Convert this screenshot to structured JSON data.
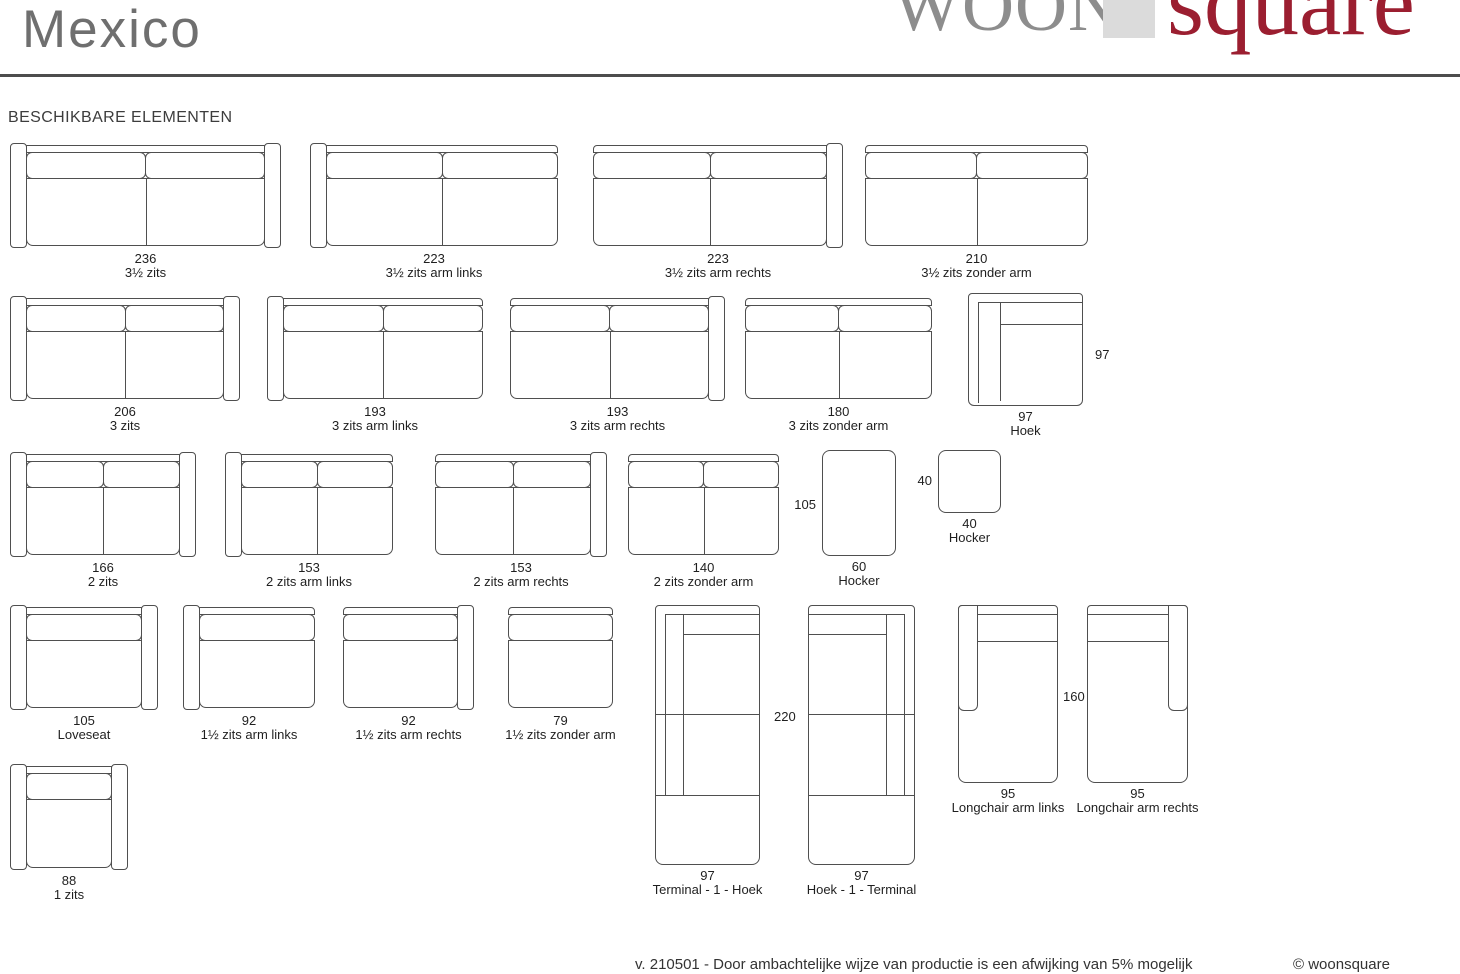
{
  "page": {
    "width": 1460,
    "height": 974,
    "line_color": "#4f4f4f"
  },
  "header": {
    "title": "Mexico",
    "rule_color": "#4d4d4d",
    "logo": {
      "woon": "WOON",
      "square_word": "square",
      "woon_color": "#8d8d8d",
      "square_color": "#9b1e30",
      "block_color": "#dbdbdb"
    }
  },
  "section": {
    "heading": "BESCHIKBARE ELEMENTEN"
  },
  "elements": [
    {
      "id": "3half-zits",
      "dim": "236",
      "label": "3½ zits",
      "type": "sofa",
      "arms": "both",
      "seats": 2,
      "x": 10,
      "y": 143,
      "w": 271,
      "h": 105
    },
    {
      "id": "3half-zits-arm-links",
      "dim": "223",
      "label": "3½ zits arm links",
      "type": "sofa",
      "arms": "left",
      "seats": 2,
      "x": 310,
      "y": 143,
      "w": 248,
      "h": 105
    },
    {
      "id": "3half-zits-arm-rechts",
      "dim": "223",
      "label": "3½ zits arm rechts",
      "type": "sofa",
      "arms": "right",
      "seats": 2,
      "x": 593,
      "y": 143,
      "w": 250,
      "h": 105
    },
    {
      "id": "3half-zits-zonder-arm",
      "dim": "210",
      "label": "3½ zits zonder arm",
      "type": "sofa",
      "arms": "none",
      "seats": 2,
      "x": 865,
      "y": 143,
      "w": 223,
      "h": 105
    },
    {
      "id": "3-zits",
      "dim": "206",
      "label": "3 zits",
      "type": "sofa",
      "arms": "both",
      "seats": 2,
      "x": 10,
      "y": 296,
      "w": 230,
      "h": 105
    },
    {
      "id": "3-zits-arm-links",
      "dim": "193",
      "label": "3 zits arm links",
      "type": "sofa",
      "arms": "left",
      "seats": 2,
      "x": 267,
      "y": 296,
      "w": 216,
      "h": 105
    },
    {
      "id": "3-zits-arm-rechts",
      "dim": "193",
      "label": "3 zits arm rechts",
      "type": "sofa",
      "arms": "right",
      "seats": 2,
      "x": 510,
      "y": 296,
      "w": 215,
      "h": 105
    },
    {
      "id": "3-zits-zonder-arm",
      "dim": "180",
      "label": "3 zits zonder arm",
      "type": "sofa",
      "arms": "none",
      "seats": 2,
      "x": 745,
      "y": 296,
      "w": 187,
      "h": 105
    },
    {
      "id": "hoek",
      "dim": "97",
      "label": "Hoek",
      "type": "hoek",
      "x": 968,
      "y": 293,
      "w": 115,
      "h": 113,
      "side": {
        "text": "97",
        "pos": "right",
        "dx": 12,
        "dy": 55
      }
    },
    {
      "id": "2-zits",
      "dim": "166",
      "label": "2 zits",
      "type": "sofa",
      "arms": "both",
      "seats": 2,
      "x": 10,
      "y": 452,
      "w": 186,
      "h": 105
    },
    {
      "id": "2-zits-arm-links",
      "dim": "153",
      "label": "2 zits arm links",
      "type": "sofa",
      "arms": "left",
      "seats": 2,
      "x": 225,
      "y": 452,
      "w": 168,
      "h": 105
    },
    {
      "id": "2-zits-arm-rechts",
      "dim": "153",
      "label": "2 zits arm rechts",
      "type": "sofa",
      "arms": "right",
      "seats": 2,
      "x": 435,
      "y": 452,
      "w": 172,
      "h": 105
    },
    {
      "id": "2-zits-zonder-arm",
      "dim": "140",
      "label": "2 zits zonder arm",
      "type": "sofa",
      "arms": "none",
      "seats": 2,
      "x": 628,
      "y": 452,
      "w": 151,
      "h": 105
    },
    {
      "id": "hocker-60",
      "dim": "60",
      "label": "Hocker",
      "type": "hocker",
      "x": 822,
      "y": 450,
      "w": 74,
      "h": 106,
      "side": {
        "text": "105",
        "pos": "left",
        "dy": 48
      }
    },
    {
      "id": "hocker-40",
      "dim": "40",
      "label": "Hocker",
      "type": "hocker",
      "x": 938,
      "y": 450,
      "w": 63,
      "h": 63,
      "side": {
        "text": "40",
        "pos": "left",
        "dy": 24
      }
    },
    {
      "id": "loveseat",
      "dim": "105",
      "label": "Loveseat",
      "type": "sofa",
      "arms": "both",
      "seats": 1,
      "x": 10,
      "y": 605,
      "w": 148,
      "h": 105
    },
    {
      "id": "1half-zits-arm-links",
      "dim": "92",
      "label": "1½ zits arm links",
      "type": "sofa",
      "arms": "left",
      "seats": 1,
      "x": 183,
      "y": 605,
      "w": 132,
      "h": 105
    },
    {
      "id": "1half-zits-arm-rechts",
      "dim": "92",
      "label": "1½ zits arm rechts",
      "type": "sofa",
      "arms": "right",
      "seats": 1,
      "x": 343,
      "y": 605,
      "w": 131,
      "h": 105
    },
    {
      "id": "1half-zits-zonder-arm",
      "dim": "79",
      "label": "1½ zits zonder arm",
      "type": "sofa",
      "arms": "none",
      "seats": 1,
      "x": 508,
      "y": 605,
      "w": 105,
      "h": 105
    },
    {
      "id": "terminal-1-hoek",
      "dim": "97",
      "label": "Terminal - 1 - Hoek",
      "type": "tall-corner",
      "backSide": "left",
      "x": 655,
      "y": 605,
      "w": 105,
      "h": 260,
      "side": {
        "text": "220",
        "pos": "right",
        "dx": 14,
        "dy": 105
      }
    },
    {
      "id": "hoek-1-terminal",
      "dim": "97",
      "label": "Hoek - 1 - Terminal",
      "type": "tall-corner",
      "backSide": "right",
      "x": 808,
      "y": 605,
      "w": 107,
      "h": 260
    },
    {
      "id": "longchair-arm-links",
      "dim": "95",
      "label": "Longchair arm links",
      "type": "longchair",
      "armSide": "left",
      "x": 958,
      "y": 605,
      "w": 100,
      "h": 178,
      "side": {
        "text": "160",
        "pos": "right",
        "dx": 5,
        "dy": 85
      }
    },
    {
      "id": "longchair-arm-rechts",
      "dim": "95",
      "label": "Longchair arm rechts",
      "type": "longchair",
      "armSide": "right",
      "x": 1087,
      "y": 605,
      "w": 101,
      "h": 178
    },
    {
      "id": "1-zits",
      "dim": "88",
      "label": "1 zits",
      "type": "sofa",
      "arms": "both",
      "seats": 1,
      "x": 10,
      "y": 764,
      "w": 118,
      "h": 106
    }
  ],
  "edge_fragments": [
    {
      "text": "5",
      "y": 344
    },
    {
      "text": "5",
      "y": 499
    },
    {
      "text": "5",
      "y": 652
    },
    {
      "text": "8",
      "y": 812
    }
  ],
  "footer": {
    "note": "v. 210501 - Door ambachtelijke wijze van productie is een afwijking van 5% mogelijk",
    "copyright": "© woonsquare"
  }
}
